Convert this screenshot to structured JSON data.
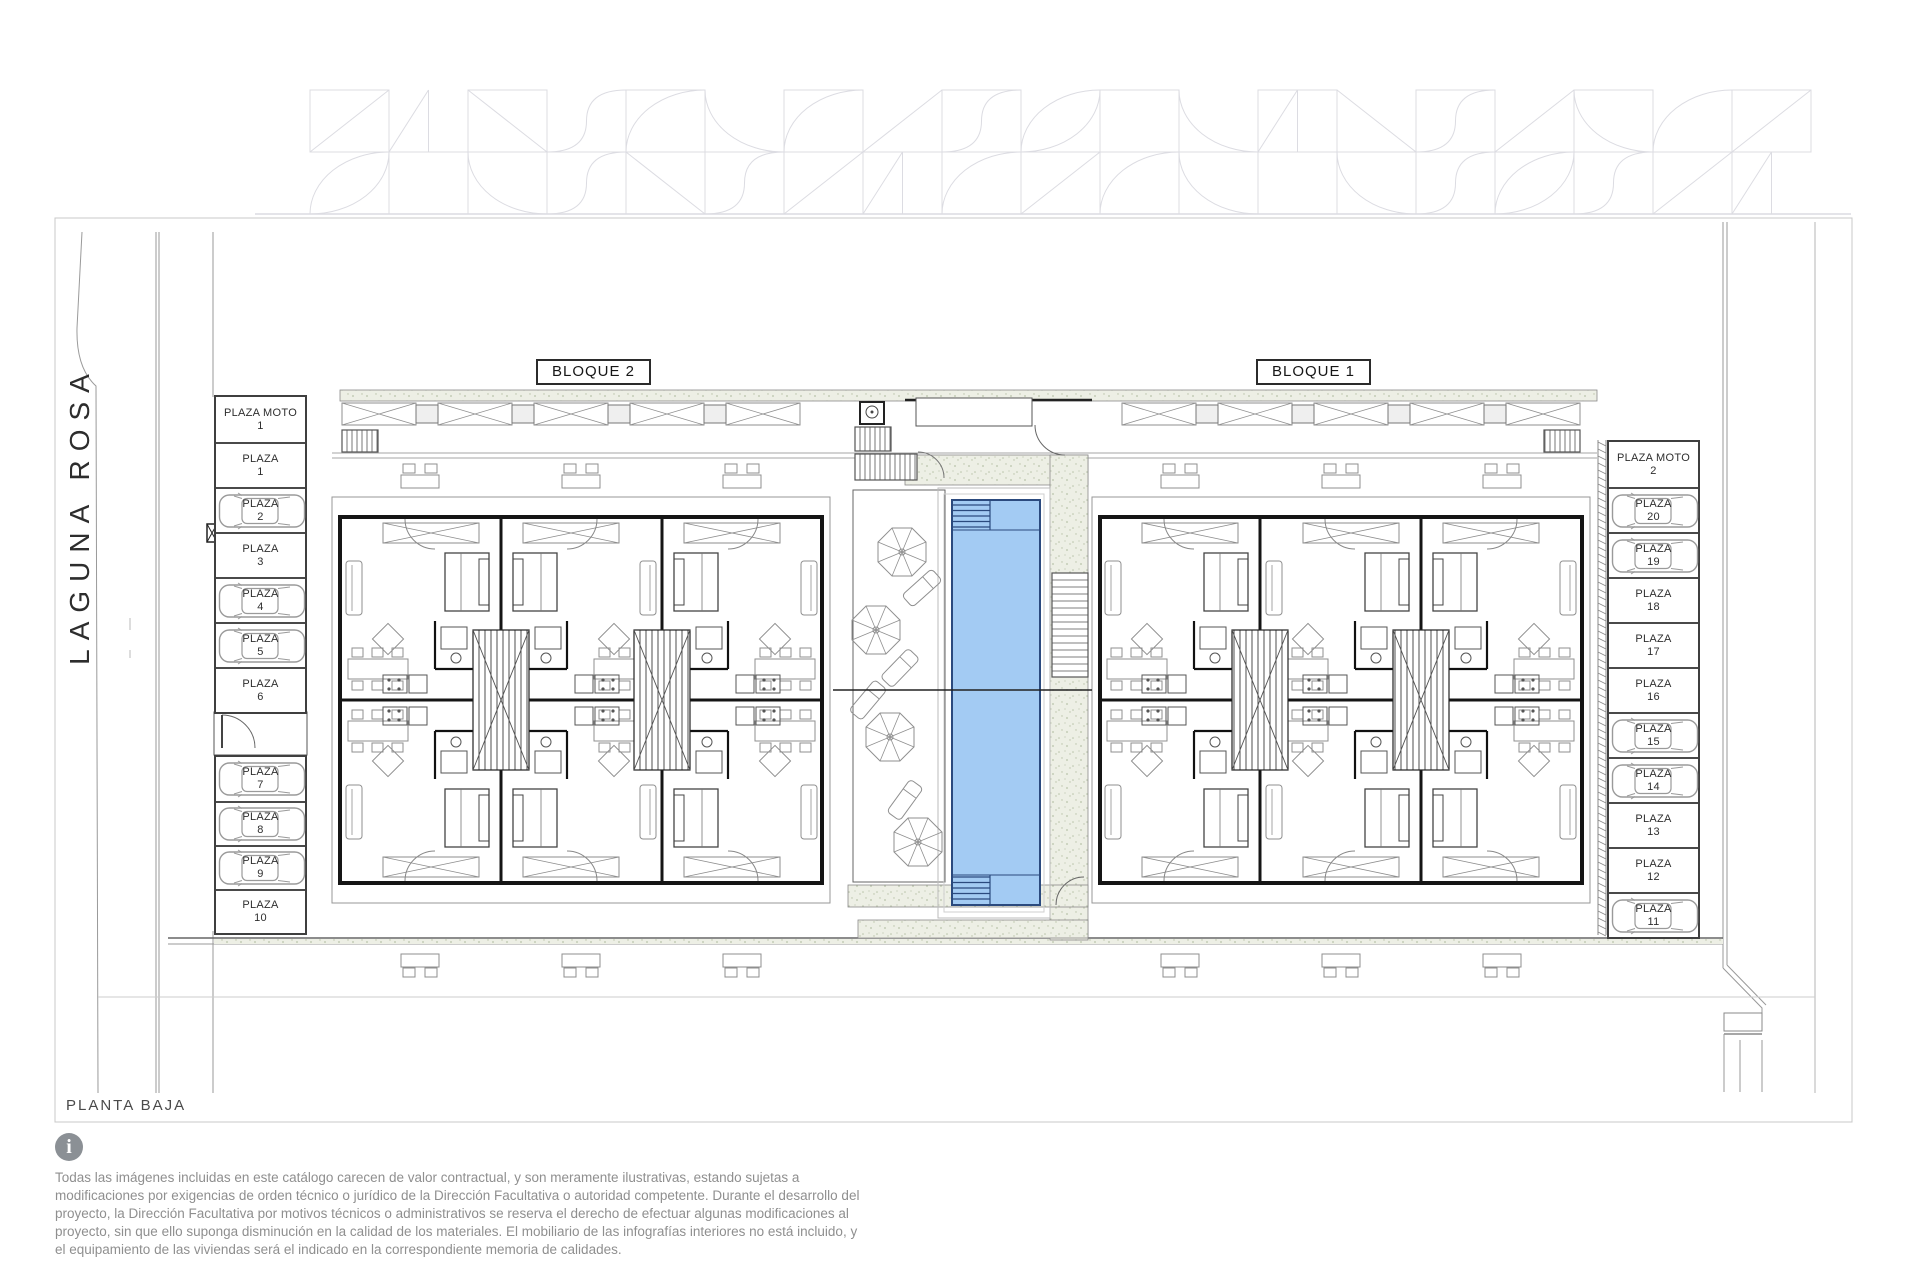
{
  "labels": {
    "street": "LAGUNA ROSA",
    "block2": "BLOQUE 2",
    "block1": "BLOQUE 1",
    "floor": "PLANTA BAJA"
  },
  "parking": {
    "left_top": [
      {
        "name": "PLAZA MOTO",
        "number": "1",
        "car": false
      },
      {
        "name": "PLAZA",
        "number": "1",
        "car": false
      },
      {
        "name": "PLAZA",
        "number": "2",
        "car": true
      },
      {
        "name": "PLAZA",
        "number": "3",
        "car": false
      },
      {
        "name": "PLAZA",
        "number": "4",
        "car": true
      },
      {
        "name": "PLAZA",
        "number": "5",
        "car": true
      },
      {
        "name": "PLAZA",
        "number": "6",
        "car": false
      }
    ],
    "left_bottom": [
      {
        "name": "PLAZA",
        "number": "7",
        "car": true
      },
      {
        "name": "PLAZA",
        "number": "8",
        "car": true
      },
      {
        "name": "PLAZA",
        "number": "9",
        "car": true
      },
      {
        "name": "PLAZA",
        "number": "10",
        "car": false
      }
    ],
    "right": [
      {
        "name": "PLAZA MOTO",
        "number": "2",
        "car": false
      },
      {
        "name": "PLAZA",
        "number": "20",
        "car": true
      },
      {
        "name": "PLAZA",
        "number": "19",
        "car": true
      },
      {
        "name": "PLAZA",
        "number": "18",
        "car": false
      },
      {
        "name": "PLAZA",
        "number": "17",
        "car": false
      },
      {
        "name": "PLAZA",
        "number": "16",
        "car": false
      },
      {
        "name": "PLAZA",
        "number": "15",
        "car": true
      },
      {
        "name": "PLAZA",
        "number": "14",
        "car": true
      },
      {
        "name": "PLAZA",
        "number": "13",
        "car": false
      },
      {
        "name": "PLAZA",
        "number": "12",
        "car": false
      },
      {
        "name": "PLAZA",
        "number": "11",
        "car": true
      }
    ]
  },
  "disclaimer": "Todas las imágenes incluidas en este catálogo carecen de valor contractual, y son meramente ilustrativas, estando sujetas a modificaciones por exigencias de orden técnico o jurídico de la Dirección Facultativa o autoridad competente. Durante el desarrollo del proyecto, la Dirección Facultativa por motivos técnicos o administrativos se reserva el derecho de efectuar algunas modificaciones al proyecto, sin que ello suponga disminución en la calidad de los materiales. El mobiliario de las infografías interiores no está incluido, y el equipamiento de las viviendas será el indicado en la correspondiente memoria de calidades.",
  "colors": {
    "pool_water": "#A3CBF3",
    "pool_edge": "#2B4A7E",
    "deck_base": "#EDEFE5",
    "deck_dot": "#B9C3A9",
    "wall": "#151515",
    "furniture": "#8F8F8F",
    "frieze": "#DCDCE2",
    "kerb": "#9A9A9A"
  }
}
